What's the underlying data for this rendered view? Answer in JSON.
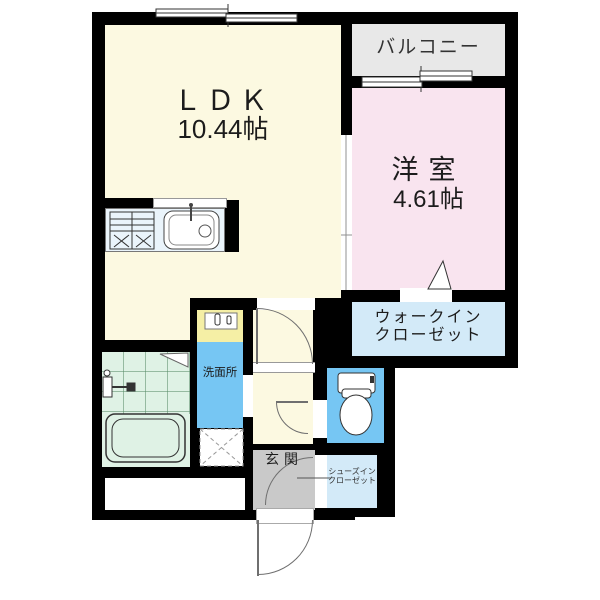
{
  "plan": {
    "type": "apartment-floor-plan",
    "rooms": {
      "ldk": {
        "label": "ＬＤＫ",
        "size": "10.44帖"
      },
      "balcony": {
        "label": "バルコニー"
      },
      "western_room": {
        "label": "洋室",
        "size": "4.61帖"
      },
      "walk_in_closet": {
        "label_line1": "ウォークイン",
        "label_line2": "クローゼット"
      },
      "washroom": {
        "label": "洗面所"
      },
      "entrance": {
        "label": "玄関"
      },
      "shoes_in_closet": {
        "label_line1": "シューズイン",
        "label_line2": "クローゼット"
      }
    },
    "fixtures": [
      "kitchen-stove",
      "kitchen-sink",
      "bathtub",
      "washbasin",
      "toilet",
      "laundry-space"
    ],
    "colors": {
      "wall": "#000000",
      "ldk": "#FCF9E1",
      "western_room": "#F9E4EF",
      "balcony": "#E8E8E8",
      "closet_blue": "#D3EAF8",
      "water_blue": "#76C6F3",
      "bathroom_green": "#DFF2E5",
      "entrance_gray": "#C9C9C9",
      "washbasin_yellow": "#F5EFA5"
    }
  }
}
